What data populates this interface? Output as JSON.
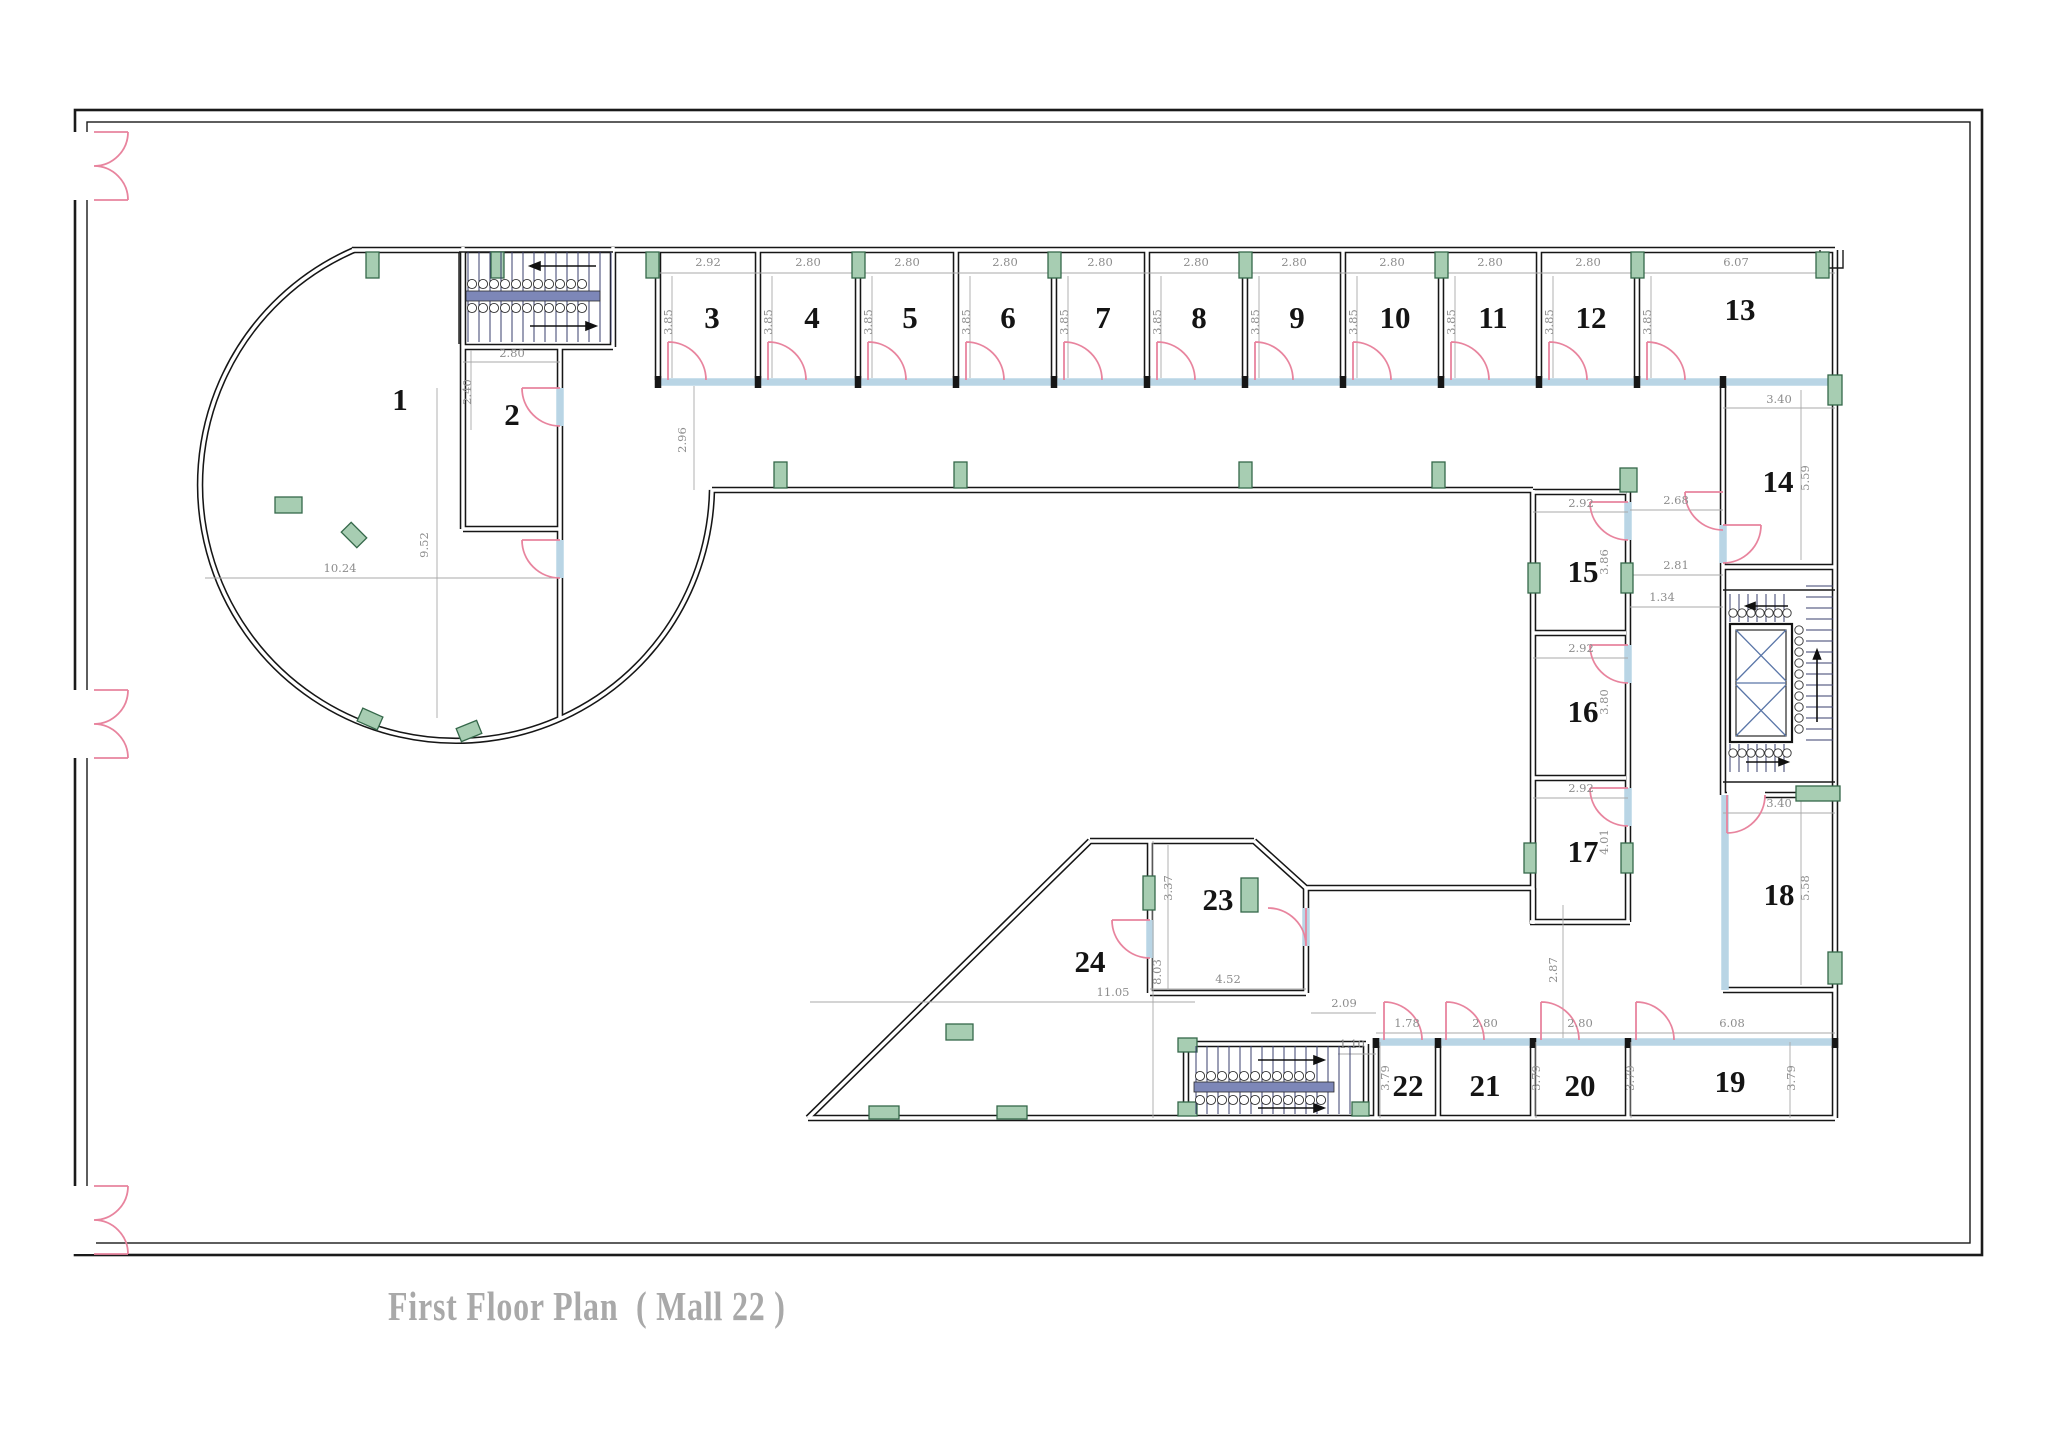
{
  "title": "First Floor Plan  ( Mall 22 )",
  "plan": {
    "room_labels": [
      {
        "n": "1",
        "x": 400,
        "y": 410
      },
      {
        "n": "2",
        "x": 512,
        "y": 425
      },
      {
        "n": "3",
        "x": 712,
        "y": 328
      },
      {
        "n": "4",
        "x": 812,
        "y": 328
      },
      {
        "n": "5",
        "x": 910,
        "y": 328
      },
      {
        "n": "6",
        "x": 1008,
        "y": 328
      },
      {
        "n": "7",
        "x": 1103,
        "y": 328
      },
      {
        "n": "8",
        "x": 1199,
        "y": 328
      },
      {
        "n": "9",
        "x": 1297,
        "y": 328
      },
      {
        "n": "10",
        "x": 1395,
        "y": 328
      },
      {
        "n": "11",
        "x": 1493,
        "y": 328
      },
      {
        "n": "12",
        "x": 1591,
        "y": 328
      },
      {
        "n": "13",
        "x": 1740,
        "y": 320
      },
      {
        "n": "14",
        "x": 1778,
        "y": 492
      },
      {
        "n": "15",
        "x": 1583,
        "y": 582
      },
      {
        "n": "16",
        "x": 1583,
        "y": 722
      },
      {
        "n": "17",
        "x": 1583,
        "y": 862
      },
      {
        "n": "18",
        "x": 1779,
        "y": 905
      },
      {
        "n": "19",
        "x": 1730,
        "y": 1092
      },
      {
        "n": "20",
        "x": 1580,
        "y": 1096
      },
      {
        "n": "21",
        "x": 1485,
        "y": 1096
      },
      {
        "n": "22",
        "x": 1408,
        "y": 1096
      },
      {
        "n": "23",
        "x": 1218,
        "y": 910
      },
      {
        "n": "24",
        "x": 1090,
        "y": 972
      }
    ],
    "dimensions": [
      {
        "t": "2.92",
        "x": 708,
        "y": 266,
        "r": 0
      },
      {
        "t": "2.80",
        "x": 808,
        "y": 266,
        "r": 0
      },
      {
        "t": "2.80",
        "x": 907,
        "y": 266,
        "r": 0
      },
      {
        "t": "2.80",
        "x": 1005,
        "y": 266,
        "r": 0
      },
      {
        "t": "2.80",
        "x": 1100,
        "y": 266,
        "r": 0
      },
      {
        "t": "2.80",
        "x": 1196,
        "y": 266,
        "r": 0
      },
      {
        "t": "2.80",
        "x": 1294,
        "y": 266,
        "r": 0
      },
      {
        "t": "2.80",
        "x": 1392,
        "y": 266,
        "r": 0
      },
      {
        "t": "2.80",
        "x": 1490,
        "y": 266,
        "r": 0
      },
      {
        "t": "2.80",
        "x": 1588,
        "y": 266,
        "r": 0
      },
      {
        "t": "6.07",
        "x": 1736,
        "y": 266,
        "r": 0
      },
      {
        "t": "3.85",
        "x": 672,
        "y": 322,
        "r": 1
      },
      {
        "t": "3.85",
        "x": 772,
        "y": 322,
        "r": 1
      },
      {
        "t": "3.85",
        "x": 872,
        "y": 322,
        "r": 1
      },
      {
        "t": "3.85",
        "x": 970,
        "y": 322,
        "r": 1
      },
      {
        "t": "3.85",
        "x": 1068,
        "y": 322,
        "r": 1
      },
      {
        "t": "3.85",
        "x": 1161,
        "y": 322,
        "r": 1
      },
      {
        "t": "3.85",
        "x": 1259,
        "y": 322,
        "r": 1
      },
      {
        "t": "3.85",
        "x": 1357,
        "y": 322,
        "r": 1
      },
      {
        "t": "3.85",
        "x": 1455,
        "y": 322,
        "r": 1
      },
      {
        "t": "3.85",
        "x": 1553,
        "y": 322,
        "r": 1
      },
      {
        "t": "3.85",
        "x": 1651,
        "y": 322,
        "r": 1
      },
      {
        "t": "2.80",
        "x": 512,
        "y": 357,
        "r": 0
      },
      {
        "t": "2.40",
        "x": 471,
        "y": 392,
        "r": 1
      },
      {
        "t": "10.24",
        "x": 340,
        "y": 572,
        "r": 0
      },
      {
        "t": "9.52",
        "x": 428,
        "y": 545,
        "r": 1
      },
      {
        "t": "2.96",
        "x": 686,
        "y": 440,
        "r": 1
      },
      {
        "t": "2.92",
        "x": 1581,
        "y": 507,
        "r": 0
      },
      {
        "t": "3.86",
        "x": 1608,
        "y": 562,
        "r": 1
      },
      {
        "t": "2.92",
        "x": 1581,
        "y": 652,
        "r": 0
      },
      {
        "t": "3.80",
        "x": 1608,
        "y": 702,
        "r": 1
      },
      {
        "t": "2.92",
        "x": 1581,
        "y": 792,
        "r": 0
      },
      {
        "t": "4.01",
        "x": 1608,
        "y": 842,
        "r": 1
      },
      {
        "t": "3.40",
        "x": 1779,
        "y": 403,
        "r": 0
      },
      {
        "t": "5.59",
        "x": 1809,
        "y": 478,
        "r": 1
      },
      {
        "t": "2.68",
        "x": 1676,
        "y": 504,
        "r": 0
      },
      {
        "t": "2.81",
        "x": 1676,
        "y": 569,
        "r": 0
      },
      {
        "t": "1.34",
        "x": 1662,
        "y": 601,
        "r": 0
      },
      {
        "t": "3.40",
        "x": 1779,
        "y": 807,
        "r": 0
      },
      {
        "t": "5.58",
        "x": 1809,
        "y": 888,
        "r": 1
      },
      {
        "t": "3.37",
        "x": 1172,
        "y": 888,
        "r": 1
      },
      {
        "t": "4.52",
        "x": 1228,
        "y": 983,
        "r": 0
      },
      {
        "t": "8.03",
        "x": 1161,
        "y": 972,
        "r": 1
      },
      {
        "t": "11.05",
        "x": 1113,
        "y": 996,
        "r": 0
      },
      {
        "t": "2.09",
        "x": 1344,
        "y": 1007,
        "r": 0
      },
      {
        "t": "1.10",
        "x": 1352,
        "y": 1048,
        "r": 0
      },
      {
        "t": "2.87",
        "x": 1557,
        "y": 970,
        "r": 1
      },
      {
        "t": "1.78",
        "x": 1407,
        "y": 1027,
        "r": 0
      },
      {
        "t": "2.80",
        "x": 1485,
        "y": 1027,
        "r": 0
      },
      {
        "t": "2.80",
        "x": 1580,
        "y": 1027,
        "r": 0
      },
      {
        "t": "6.08",
        "x": 1732,
        "y": 1027,
        "r": 0
      },
      {
        "t": "3.79",
        "x": 1389,
        "y": 1078,
        "r": 1
      },
      {
        "t": "3.79",
        "x": 1540,
        "y": 1078,
        "r": 1
      },
      {
        "t": "3.79",
        "x": 1634,
        "y": 1078,
        "r": 1
      },
      {
        "t": "3.79",
        "x": 1795,
        "y": 1078,
        "r": 1
      }
    ]
  },
  "colors": {
    "wall": "#161616",
    "sill": "#b9d5e5",
    "door": "#e8849e",
    "column_fill": "#a7cdb2",
    "column_edge": "#35684a",
    "rail": "#7d87b8",
    "dim": "#8d8d8d",
    "title": "#a9a9a9"
  }
}
